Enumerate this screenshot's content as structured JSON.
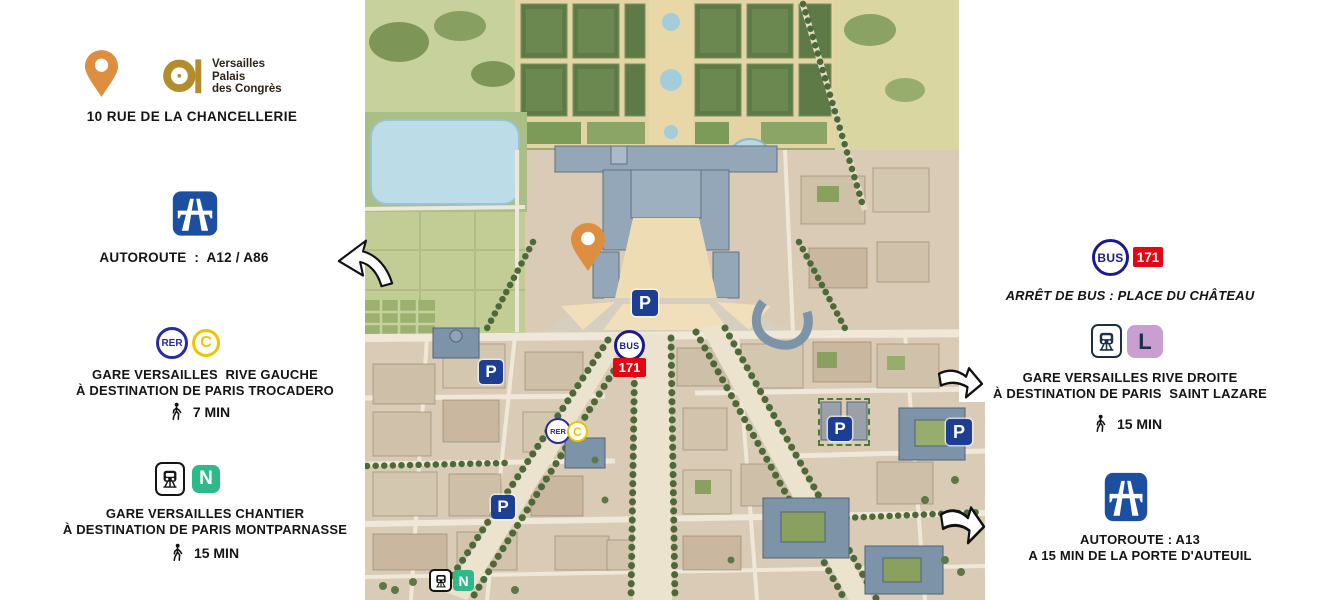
{
  "brand": {
    "logo_lines": [
      "Versailles",
      "Palais",
      "des Congrès"
    ],
    "address": "10 RUE DE LA CHANCELLERIE"
  },
  "left_panel": {
    "autoroute": {
      "label": "AUTOROUTE  :  A12 / A86"
    },
    "rer_c": {
      "badge_rer": "RER",
      "badge_line": "C",
      "line1": "GARE VERSAILLES  RIVE GAUCHE",
      "line2": "À DESTINATION DE PARIS TROCADERO",
      "walk_time": "7 MIN"
    },
    "train_n": {
      "badge_line": "N",
      "line1": "GARE VERSAILLES CHANTIER",
      "line2": "À DESTINATION DE PARIS MONTPARNASSE",
      "walk_time": "15 MIN"
    }
  },
  "right_panel": {
    "bus": {
      "badge": "BUS",
      "line_number": "171",
      "stop_label": "ARRÊT DE BUS : PLACE DU CHÂTEAU"
    },
    "train_l": {
      "badge_line": "L",
      "line1": "GARE VERSAILLES RIVE DROITE",
      "line2": "À DESTINATION DE PARIS  SAINT LAZARE",
      "walk_time": "15 MIN"
    },
    "autoroute": {
      "line1": "AUTOROUTE : A13",
      "line2": "A 15 MIN DE LA PORTE D'AUTEUIL"
    }
  },
  "map_markers": {
    "parking": "P",
    "bus": "BUS",
    "bus_line": "171",
    "rer": "RER",
    "rer_line": "C",
    "train_line": "N"
  },
  "colors": {
    "accent_orange": "#DD8F3F",
    "logo_gold": "#B18D2E",
    "autoroute_blue": "#1D4FA1",
    "rer_navy": "#2B2BA0",
    "line_c_yellow": "#EFC400",
    "line_n_green": "#2EB98A",
    "line_l_lilac": "#C89FD0",
    "bus_navy": "#1B1B8F",
    "line_171_red": "#E30613",
    "parking_blue": "#1C3F94",
    "text_dark": "#141414"
  }
}
